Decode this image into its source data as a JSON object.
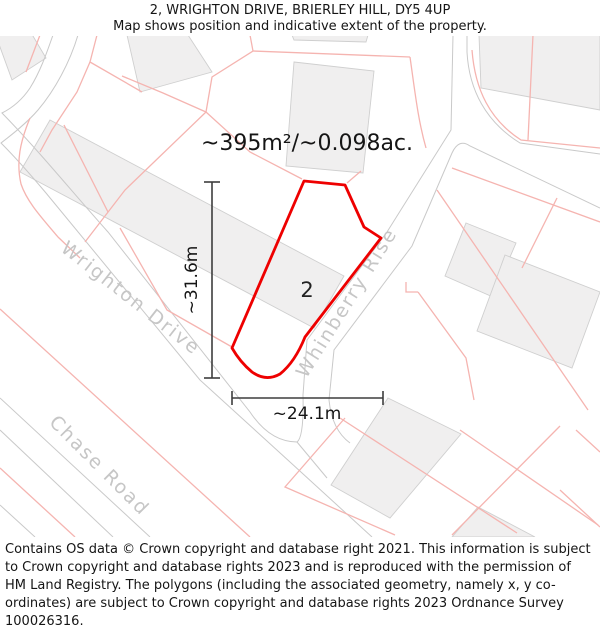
{
  "title": {
    "line1": "2, WRIGHTON DRIVE, BRIERLEY HILL, DY5 4UP",
    "line2": "Map shows position and indicative extent of the property."
  },
  "map": {
    "area_label": "~395m²/~0.098ac.",
    "plot_number": "2",
    "dimensions": {
      "vertical": "~31.6m",
      "horizontal": "~24.1m"
    },
    "streets": {
      "wrighton": "Wrighton Drive",
      "whinberry": "Whinberry Rise",
      "chase": "Chase Road"
    },
    "colors": {
      "property_outline": "#ee0000",
      "parcel_line": "#f5b4b0",
      "road_line": "#c9c9c9",
      "building_fill": "#f0efef",
      "building_stroke": "#cfcfcf",
      "street_text": "#c6c6c6",
      "dimension_line": "#3d3d3d",
      "text": "#151515"
    }
  },
  "footer": {
    "text": "Contains OS data © Crown copyright and database right 2021. This information is subject to Crown copyright and database rights 2023 and is reproduced with the permission of HM Land Registry. The polygons (including the associated geometry, namely x, y co-ordinates) are subject to Crown copyright and database rights 2023 Ordnance Survey 100026316."
  }
}
